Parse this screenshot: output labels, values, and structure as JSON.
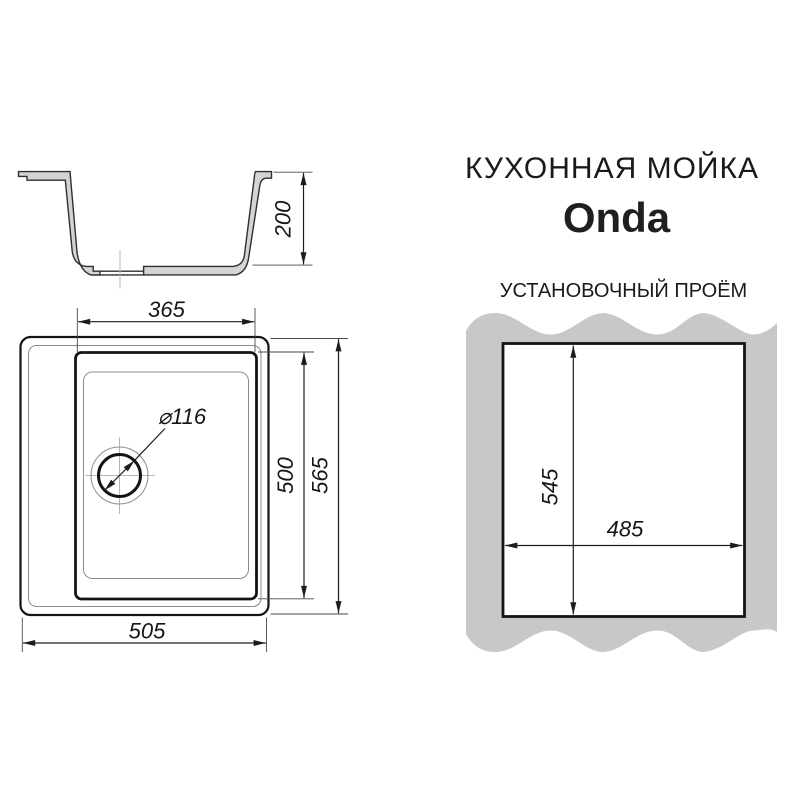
{
  "header": {
    "category_title": "КУХОННАЯ МОЙКА",
    "product_name": "Onda",
    "cutout_title": "УСТАНОВОЧНЫЙ ПРОЁМ"
  },
  "dimensions": {
    "depth": "200",
    "bowl_width": "365",
    "bowl_length": "500",
    "overall_length": "565",
    "overall_width": "505",
    "drain_diameter": "⌀116",
    "cutout_length": "545",
    "cutout_width": "485"
  },
  "colors": {
    "line": "#1c1c1c",
    "section_fill": "#d4d4d4",
    "countertop_fill": "#c8c8c8",
    "background": "#ffffff"
  }
}
